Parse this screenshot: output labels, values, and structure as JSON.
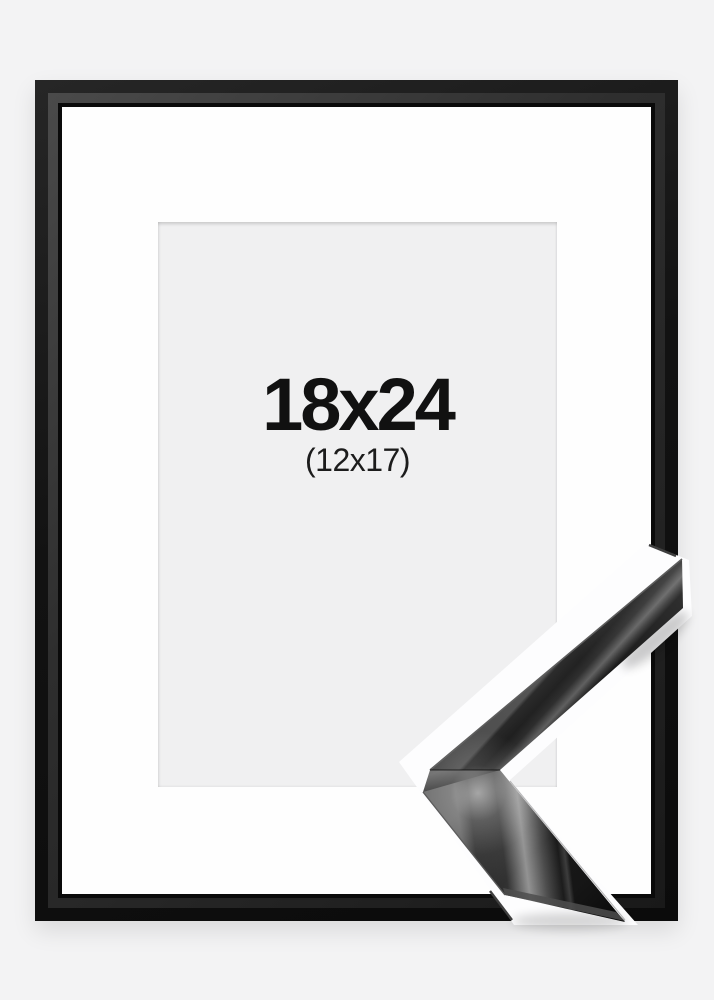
{
  "frame_photo": {
    "size_label": "18x24",
    "matted_size_label": "(12x17)",
    "colors": {
      "background": "#f3f3f4",
      "frame_black": "#131313",
      "frame_bevel_gray": "#3a3a3a",
      "mat_white": "#fefefe",
      "window_gray": "#f0f0f1",
      "text": "#111111",
      "detail_backdrop_white": "#fdfdfe",
      "moulding_highlight": "#8f8f8f"
    }
  }
}
